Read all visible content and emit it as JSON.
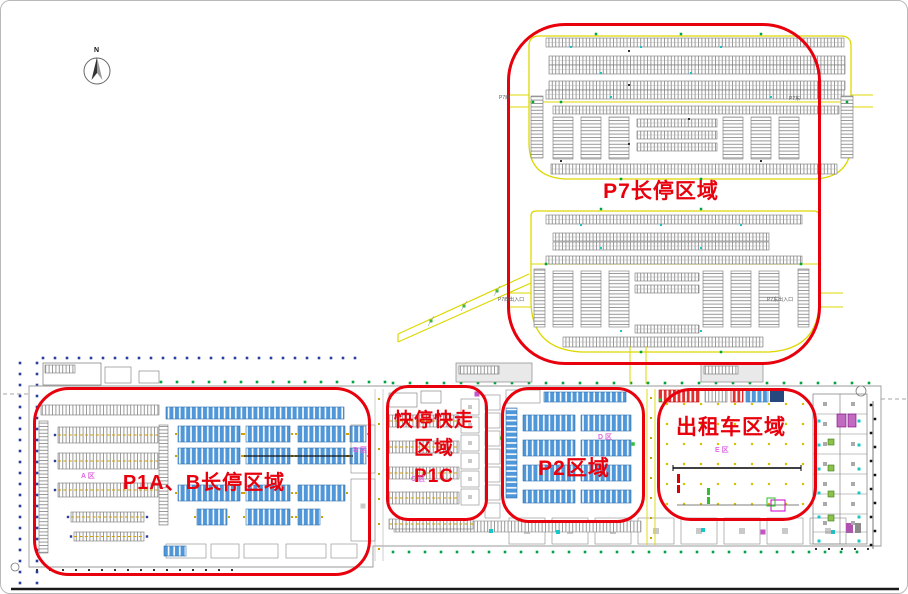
{
  "compass": {
    "label": "N"
  },
  "annotations": {
    "p7": {
      "label": "P7长停区域"
    },
    "p1ab": {
      "label": "P1A、B长停区域"
    },
    "p1c": {
      "line1": "快停快走",
      "line2": "区域",
      "line3": "P1C"
    },
    "p2": {
      "label": "P2区域"
    },
    "taxi": {
      "label": "出租车区域"
    }
  },
  "plan_labels": {
    "p7_west": "P7西",
    "p7_east": "P7东",
    "p7_west_gate": "P7西出入口",
    "p7_east_gate": "P7东出入口"
  },
  "zone_labels": {
    "a": "A 区",
    "b": "B 区",
    "c": "C 区",
    "d": "D 区",
    "e": "E 区"
  },
  "colors": {
    "annotation_red": "#e8000d",
    "road_yellow": "#ddd800",
    "stall_blue": "#4f97d8",
    "stall_gray": "#7a7a7a",
    "stall_red": "#e03030",
    "zone_label_pink": "#e06ae0",
    "grid_dot_blue": "#2b3f9e",
    "grid_dot_green": "#00a33e",
    "taxi_dot_yellow": "#d8c300",
    "accent_cyan": "#16c7c7",
    "accent_magenta": "#c555c5"
  }
}
